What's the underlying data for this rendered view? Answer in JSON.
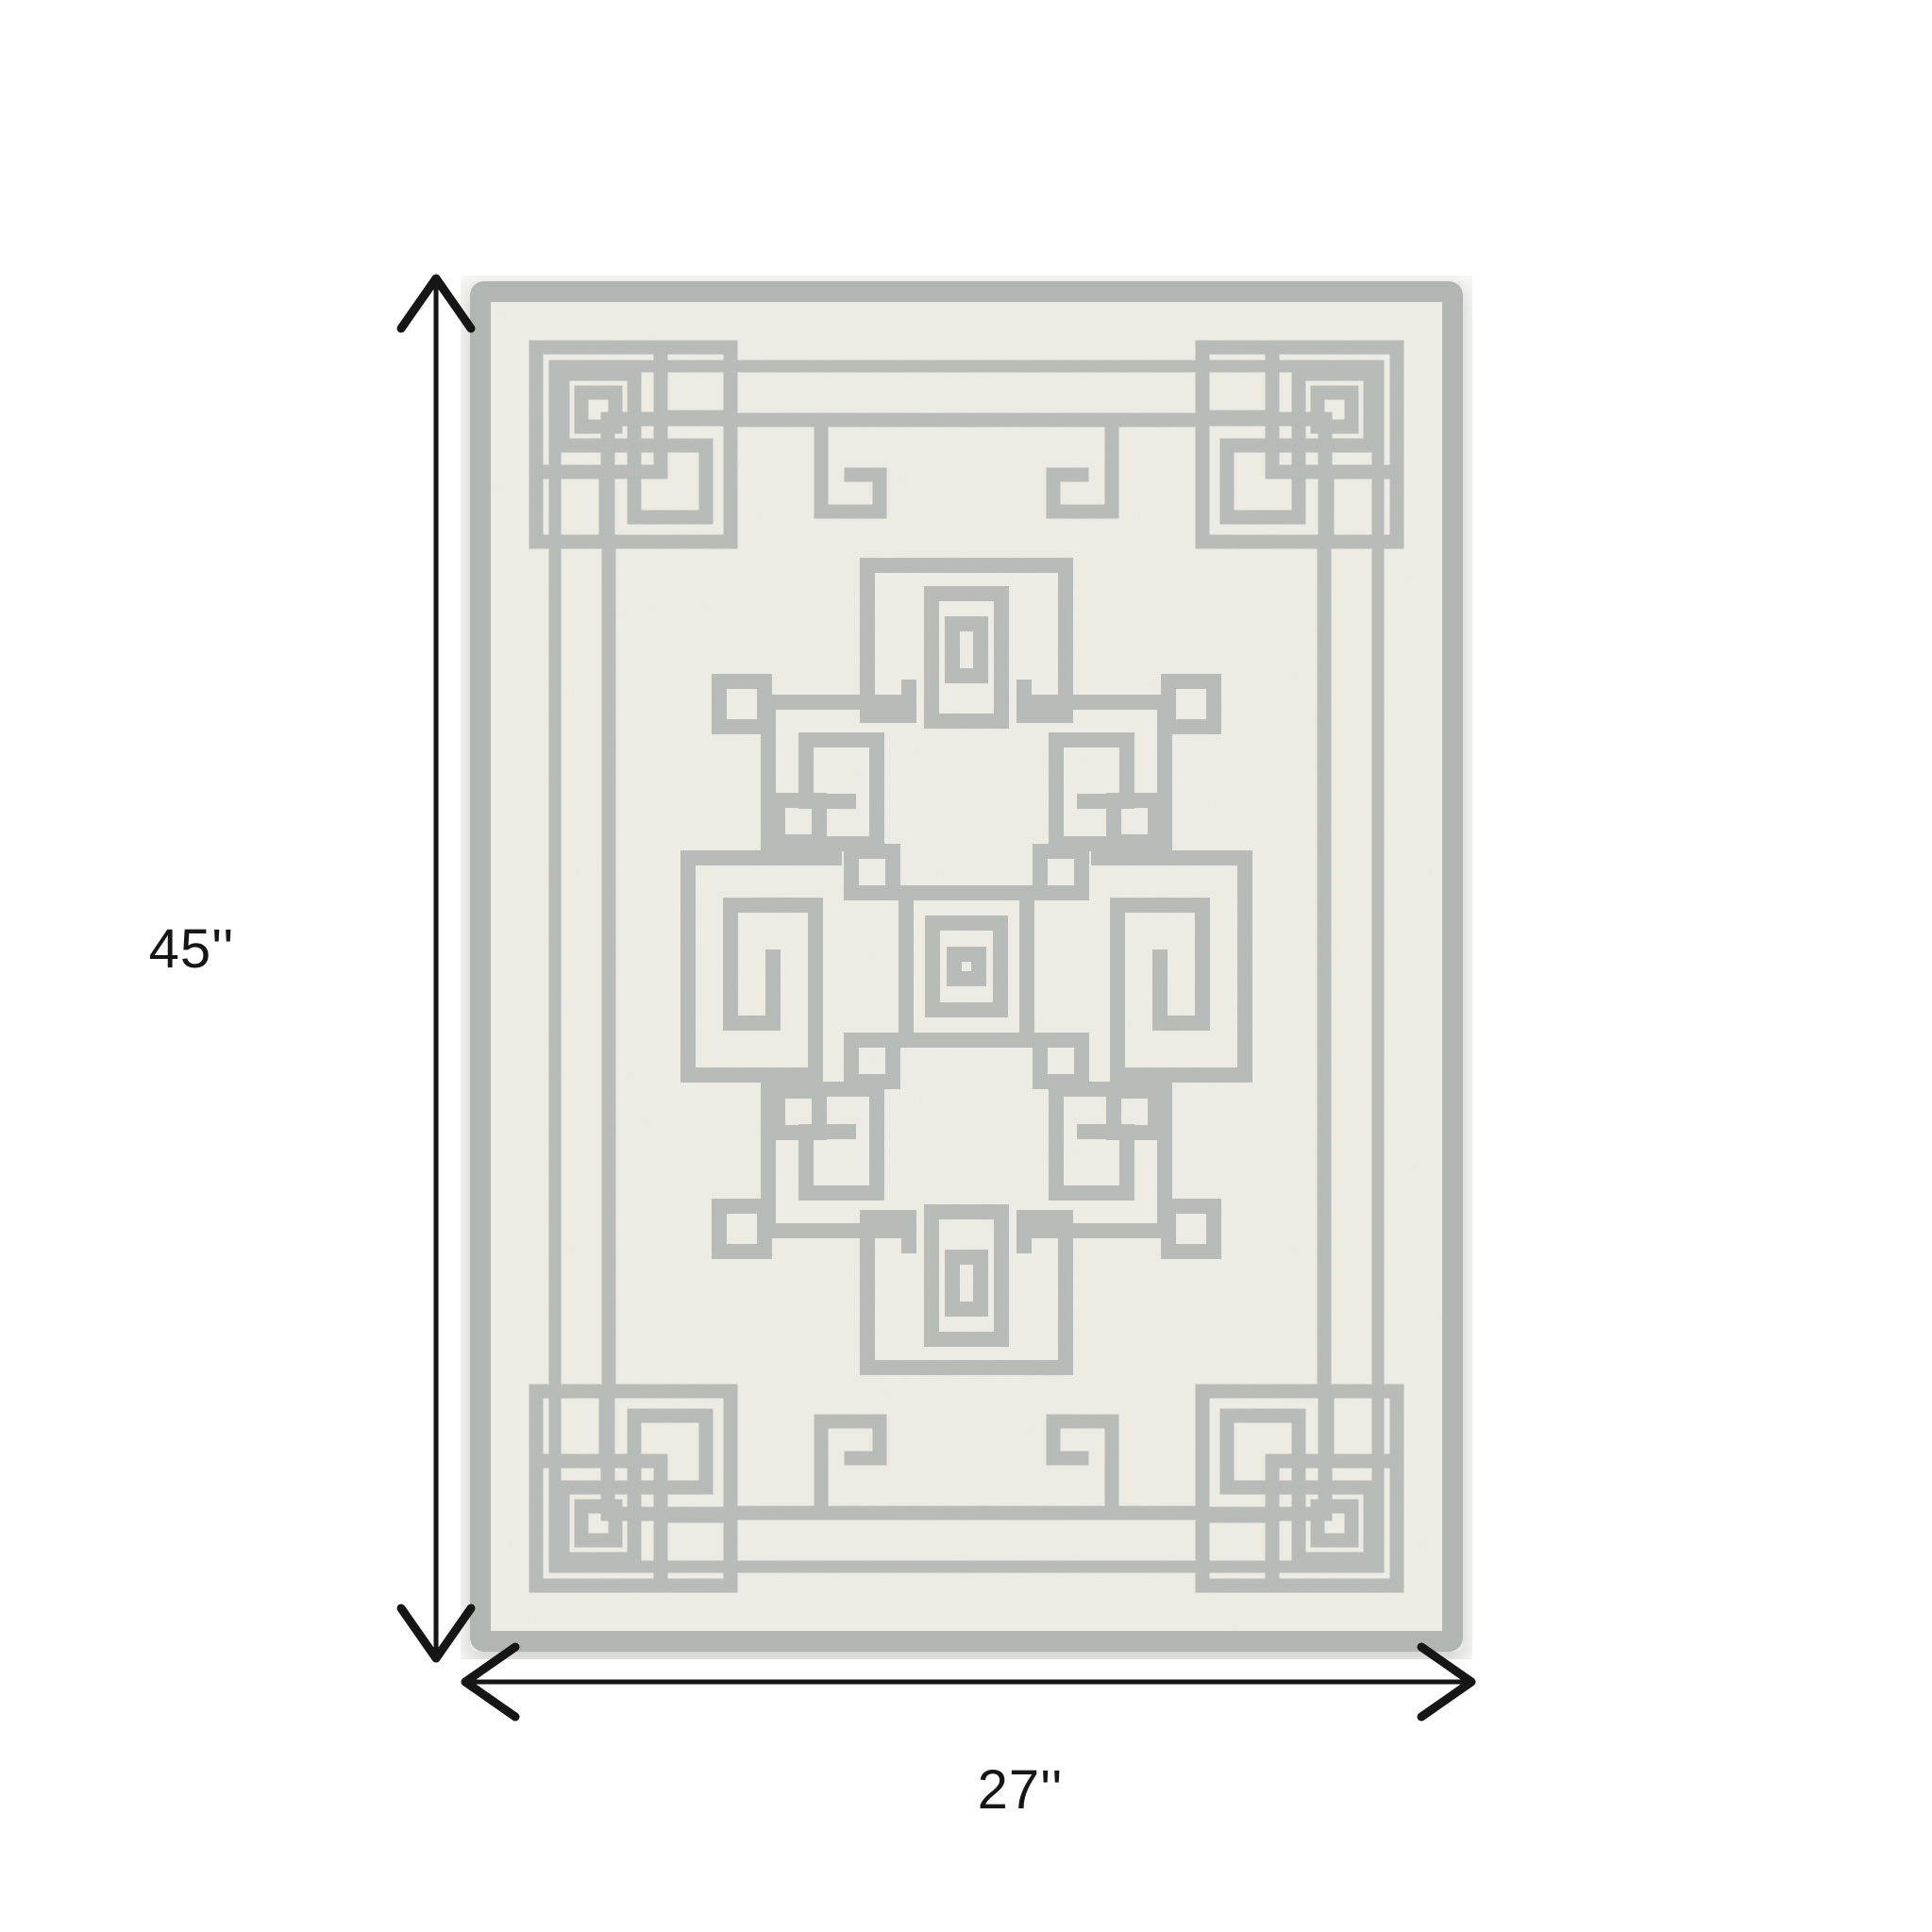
{
  "figure": {
    "type": "product-dimension-diagram",
    "product": "geometric greek-key area rug",
    "dimensions": {
      "height": {
        "label": "45''",
        "value": 45
      },
      "width": {
        "label": "27''",
        "value": 27
      }
    },
    "annotation": {
      "color": "#161616"
    },
    "rug": {
      "photo_background": "#f6f6f5",
      "field_color": "#efeee6",
      "pattern_color": "#b8bcb8",
      "edge_band_color": "#b2b6b2"
    }
  }
}
